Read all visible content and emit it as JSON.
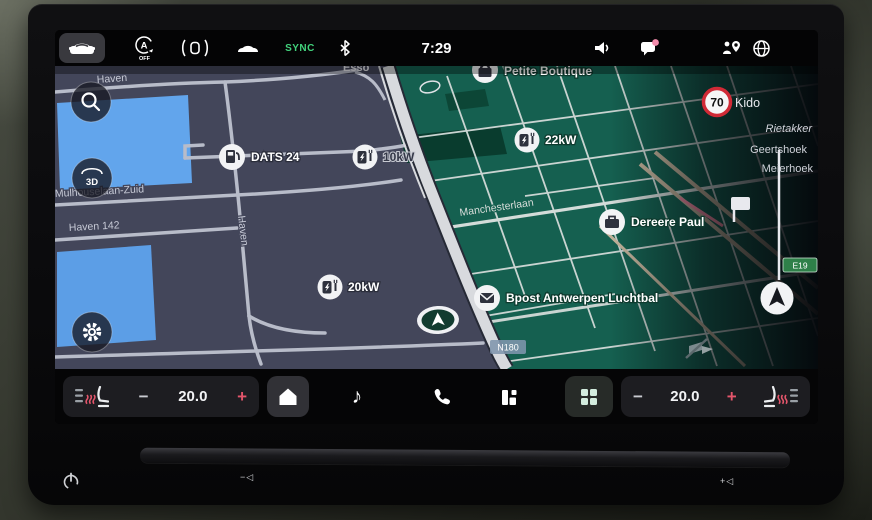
{
  "status_bar": {
    "time": "7:29",
    "sync_label": "SYNC"
  },
  "map": {
    "labels": {
      "haven": "Haven",
      "haven_142": "Haven 142",
      "mulhouselaan": "Mulhouselaan-Zuid",
      "manchesterlaan": "Manchesterlaan",
      "kido": "Kido",
      "rietakker": "Rietakker",
      "geertshoek": "Geertshoek",
      "meierhoek": "Meierhoek",
      "esso_partial": "Esso"
    },
    "pois": {
      "dats24": "DATS 24",
      "petite_boutique": "Petite Boutique",
      "charger_22": "22kW",
      "charger_10": "10kW",
      "charger_20": "20kW",
      "dereere_paul": "Dereere Paul",
      "bpost": "Bpost Antwerpen Luchtbal"
    },
    "shields": {
      "e19": "E19",
      "n180": "N180"
    },
    "speed_limit": "70",
    "controls": {
      "view_3d": "3D"
    }
  },
  "dock": {
    "temp_left": "20.0",
    "temp_right": "20.0",
    "minus": "−",
    "plus": "+"
  },
  "bezel": {
    "vol_down": "−◁",
    "vol_up": "+◁"
  },
  "colors": {
    "accent_red": "#e3556b",
    "badge_pink": "#f28bab",
    "sync_green": "#42d27c",
    "water_blue": "#62a5ec",
    "map_green": "#156050",
    "map_land": "#43465a"
  }
}
